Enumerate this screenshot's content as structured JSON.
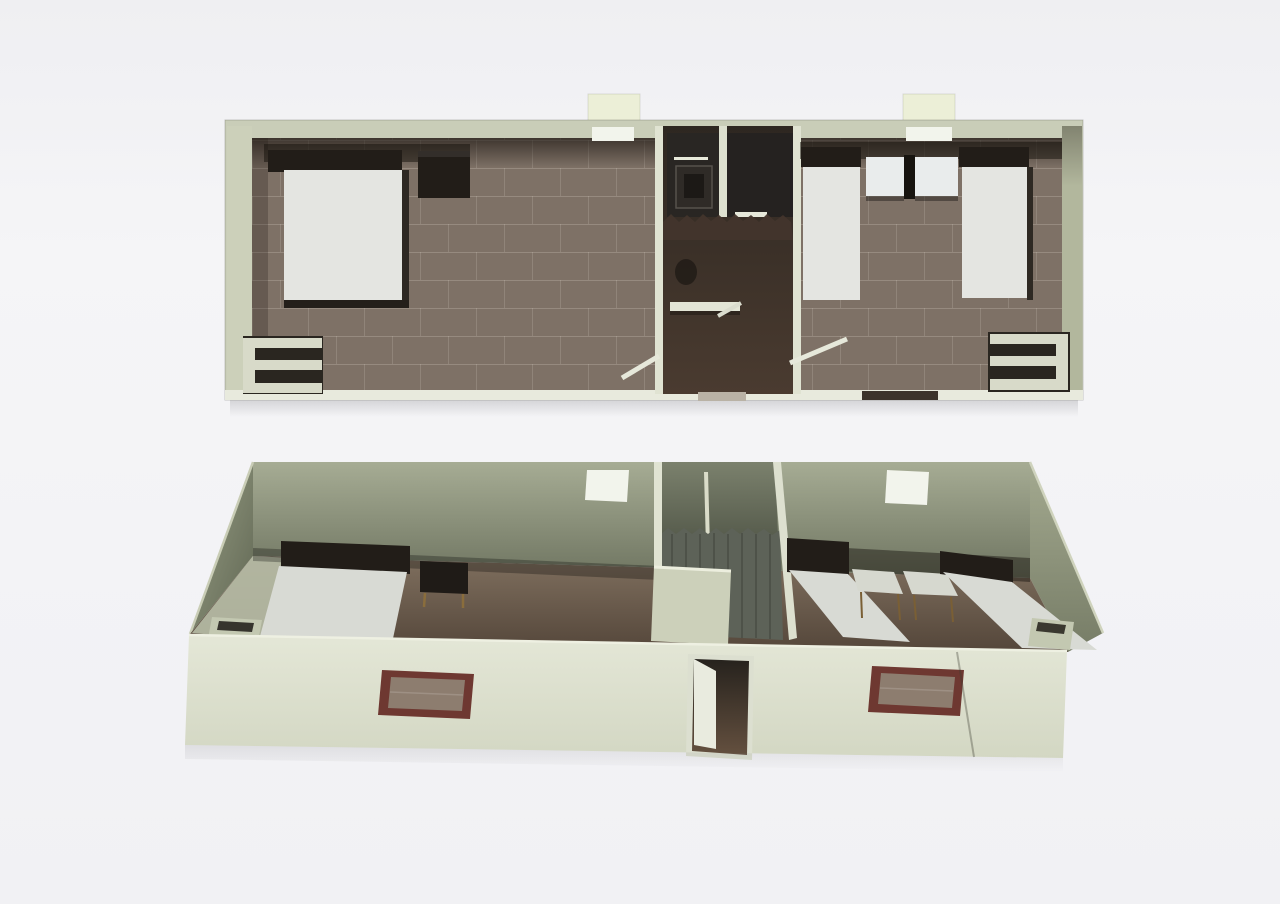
{
  "page": {
    "background": "#f3f3f6",
    "kind": "scanned 3D renderings of a rectangular modular cabin, two views, no text"
  },
  "palette": {
    "paper": "#f3f3f6",
    "wall_band": "#c9cdb8",
    "wall_side_left": "#ccd0ba",
    "wall_side_right": "#b2b79d",
    "wall_front_light": "#e0e4d2",
    "wall_back_mid": "#9aa089",
    "floor_tile": "#7e7166",
    "floor_hall_dark": "#42352c",
    "stall_dark": "#292623",
    "furniture_dark": "#221d18",
    "mattress": "#e4e5e1",
    "mattress_persp": "#d8dad4",
    "shelf_light": "#d8dac9",
    "skylight": "#ecefd7",
    "white_fixture": "#f2f4ec",
    "bench_white": "#e3e5d6",
    "window_frame": "#6e3831",
    "window_pane": "#8d7d6f",
    "door_panel": "#e9ebdf",
    "bin_body": "#c3c8b1",
    "table_leg_gold": "#8a6d3c",
    "curtain": "#5d6258"
  },
  "views": [
    {
      "id": "top-down-view",
      "label": "Top-down cutaway view of cabin",
      "rooms": [
        {
          "id": "bedroom-left",
          "furniture": [
            "double-bed",
            "wall-cabinet",
            "shelf-unit"
          ]
        },
        {
          "id": "bathroom-core",
          "furniture": [
            "shower-stall",
            "shower-stall",
            "shower-curtain",
            "toilet",
            "bench",
            "swing-door",
            "swing-door"
          ]
        },
        {
          "id": "bedroom-right",
          "furniture": [
            "single-bed",
            "bedside-table",
            "bedside-table",
            "single-bed",
            "shelf-unit"
          ]
        }
      ],
      "features": [
        "skylight-left",
        "skylight-right",
        "ceiling-light-left",
        "ceiling-light-right",
        "entry-threshold"
      ]
    },
    {
      "id": "perspective-view",
      "label": "Angled perspective view of cabin",
      "rooms": [
        {
          "id": "bedroom-left",
          "furniture": [
            "double-bed",
            "nightstand",
            "waste-bin"
          ]
        },
        {
          "id": "bathroom-core",
          "furniture": [
            "shower-curtain",
            "partition-walls"
          ]
        },
        {
          "id": "bedroom-right",
          "furniture": [
            "single-bed",
            "bedside-table",
            "bedside-table",
            "single-bed",
            "waste-bin"
          ]
        }
      ],
      "features": [
        "back-wall-window-left",
        "back-wall-window-right",
        "front-window-left",
        "front-window-right",
        "entrance-door",
        "panel-joint"
      ]
    }
  ]
}
